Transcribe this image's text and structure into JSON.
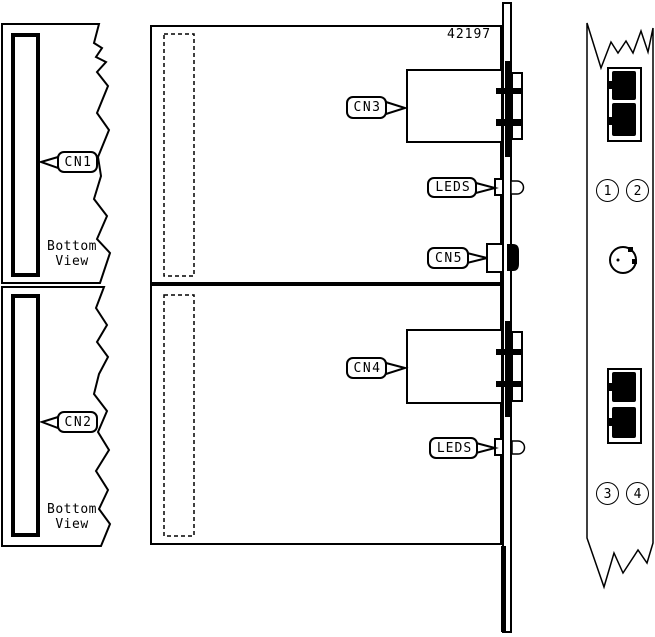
{
  "part_number": "42197",
  "callouts": {
    "cn1": "CN1",
    "cn2": "CN2",
    "cn3": "CN3",
    "cn4": "CN4",
    "cn5": "CN5",
    "leds_top": "LEDS",
    "leds_bottom": "LEDS"
  },
  "views": {
    "top_bottom_view": "Bottom\nView",
    "lower_bottom_view": "Bottom\nView"
  },
  "front_panel": {
    "ports": [
      "1",
      "2",
      "3",
      "4"
    ]
  },
  "colors": {
    "line": "#000000",
    "background": "#ffffff"
  }
}
